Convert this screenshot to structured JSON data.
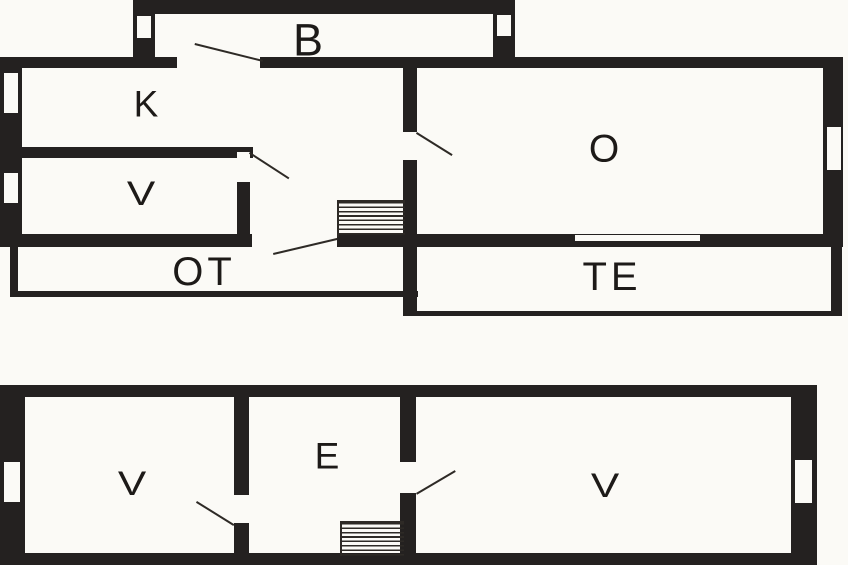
{
  "title": "Two-storey floor plan",
  "colors": {
    "wall": "#242120",
    "floor": "#fbfaf6",
    "line": "#2e2a26",
    "text": "#1d1a18"
  },
  "plans": {
    "upper": {
      "rooms": {
        "b": "B",
        "k": "K",
        "v": "V",
        "o": "O",
        "ot": "OT",
        "te": "TE"
      }
    },
    "ground": {
      "rooms": {
        "v_left": "V",
        "e": "E",
        "v_right": "V"
      }
    }
  }
}
